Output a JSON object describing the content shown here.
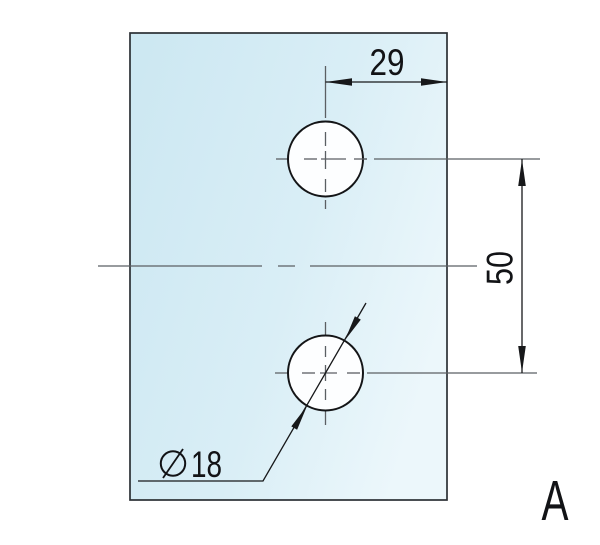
{
  "drawing": {
    "type": "technical-dimension-drawing",
    "part_shape": "rectangular plate with two circular holes",
    "view_label": "A",
    "dimensions": {
      "horizontal_dim": "29",
      "vertical_dim": "50",
      "hole_diameter": "18",
      "diameter_symbol": "⌀"
    },
    "colors": {
      "background": "#ffffff",
      "plate_fill_start": "#cde8f2",
      "plate_fill_mid": "#d9eef6",
      "plate_fill_end": "#ecf7fb",
      "plate_stroke": "#2b3034",
      "hole_fill": "#fdfeff",
      "dimension_line": "#17181a",
      "centerline": "#5b5f63",
      "text": "#121316"
    }
  }
}
